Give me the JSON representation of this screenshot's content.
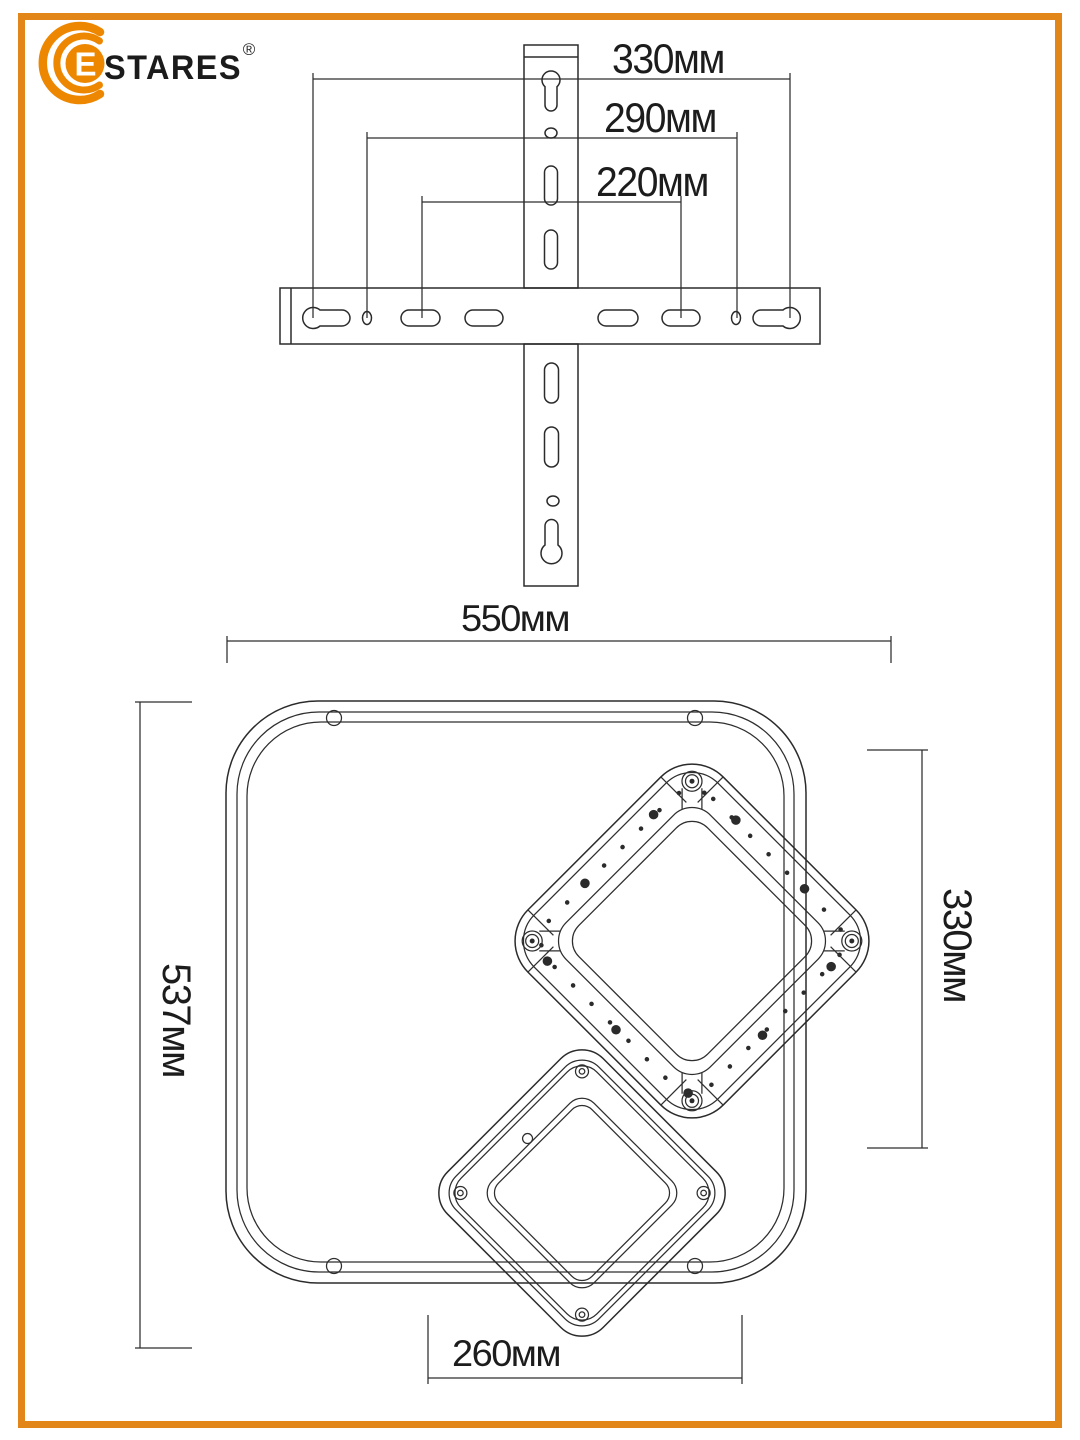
{
  "brand": {
    "logo_initial": "E",
    "logo_text": "STARES",
    "registered_mark": "®",
    "logo_orange": "#EE8700",
    "border_color": "#E2861A",
    "line_color": "#2b2b2b"
  },
  "bracket": {
    "description": "wall-mount cross bracket top view",
    "dimensions": [
      {
        "label": "330мм",
        "value_mm": 330
      },
      {
        "label": "290мм",
        "value_mm": 290
      },
      {
        "label": "220мм",
        "value_mm": 220
      }
    ]
  },
  "lamp": {
    "description": "square ceiling light with two rotated square rings",
    "dimensions": {
      "top": {
        "label": "550мм",
        "value_mm": 550
      },
      "left": {
        "label": "537мм",
        "value_mm": 537
      },
      "right": {
        "label": "330мм",
        "value_mm": 330
      },
      "bottom": {
        "label": "260мм",
        "value_mm": 260
      }
    }
  }
}
